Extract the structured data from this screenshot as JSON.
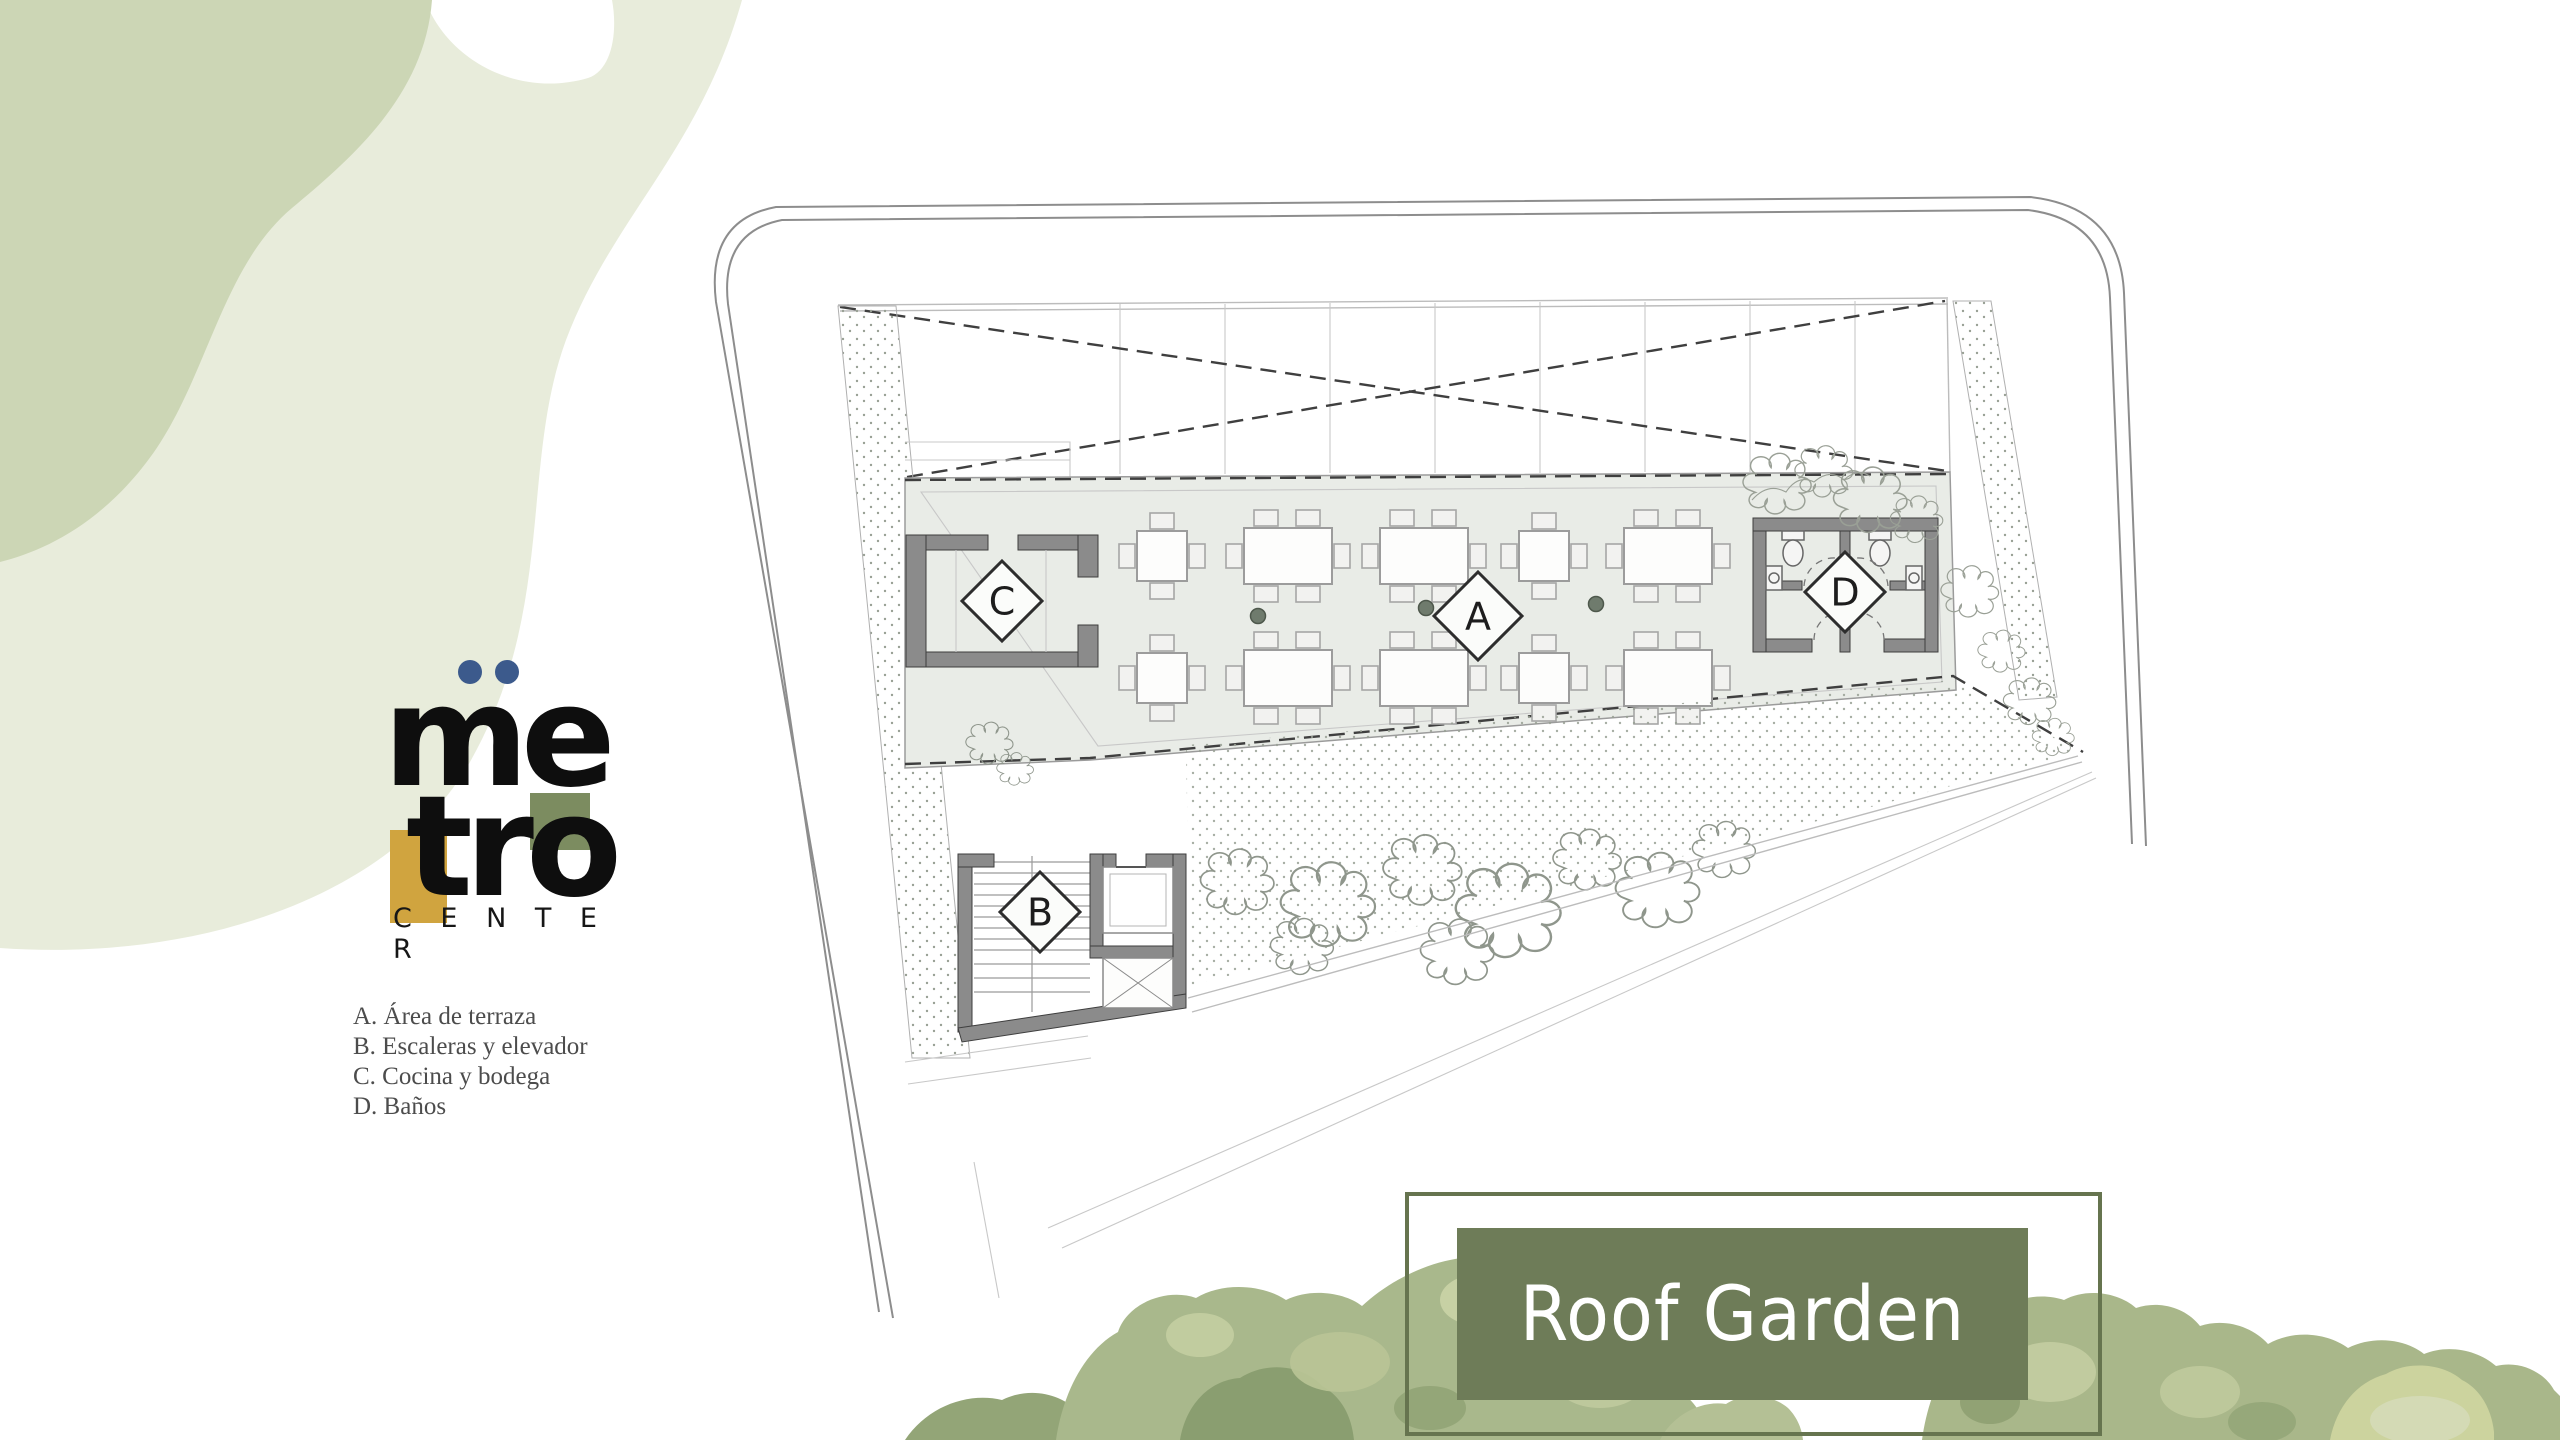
{
  "page": {
    "title": "Roof Garden floor plan",
    "background": "#ffffff"
  },
  "logo": {
    "line1": "me",
    "line2": "tro",
    "subtitle": "C E N T E R",
    "dot_color": "#3c5a8c",
    "accent_yellow": "#d0a43f",
    "accent_green": "#7c8c60",
    "text_color": "#0e0e0e"
  },
  "legend": {
    "items": [
      "A. Área de terraza",
      "B. Escaleras y elevador",
      "C. Cocina y bodega",
      "D. Baños"
    ]
  },
  "title_box": {
    "label": "Roof Garden",
    "fill": "#6e7c58",
    "border_color": "#66744f",
    "text_color": "#ffffff"
  },
  "plan": {
    "labels": {
      "a": "A",
      "b": "B",
      "c": "C",
      "d": "D"
    },
    "rooms": [
      {
        "key": "A",
        "name": "Área de terraza"
      },
      {
        "key": "B",
        "name": "Escaleras y elevador"
      },
      {
        "key": "C",
        "name": "Cocina y bodega"
      },
      {
        "key": "D",
        "name": "Baños"
      }
    ],
    "colors": {
      "wall": "#8b8b8b",
      "slab": "#e9ece7",
      "dash": "#3f3f3f",
      "stipple": "#98a094"
    }
  },
  "decor": {
    "blob_light": "#e8ecdb",
    "blob_dark": "#ccd6b5",
    "tree_palette": [
      "#a9b88c",
      "#c3cda3",
      "#8a9e70",
      "#ccd39e",
      "#d6dcba",
      "#93a577"
    ]
  }
}
